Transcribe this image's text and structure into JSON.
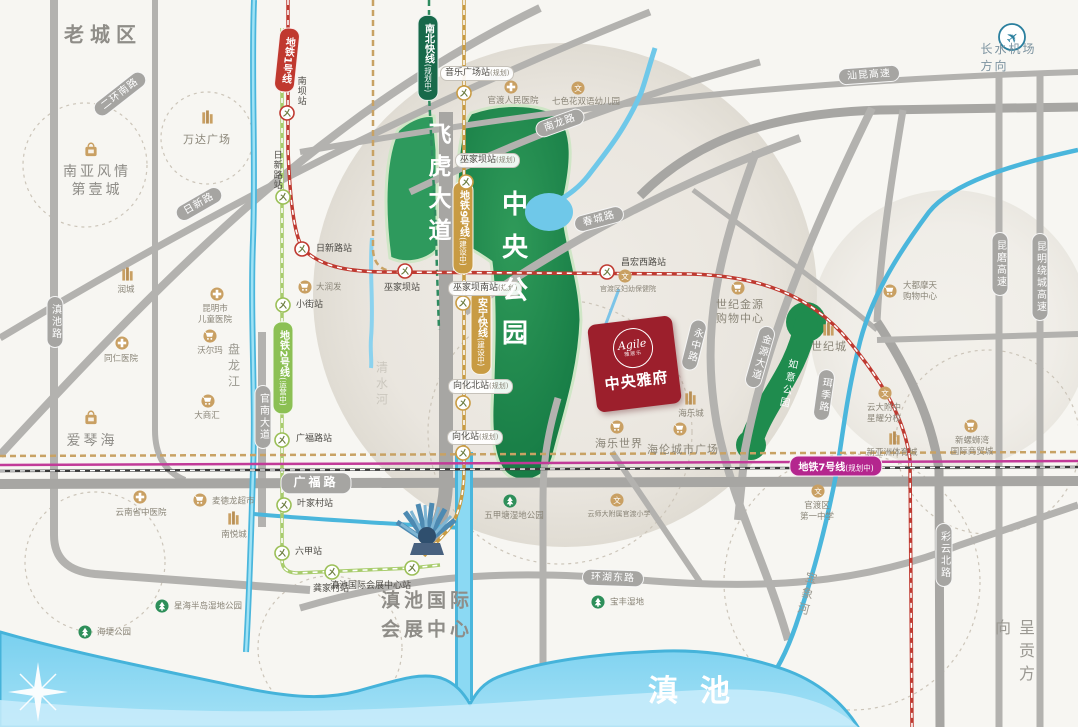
{
  "project": {
    "name": "中央雅府",
    "brand": "Agile",
    "brand_sub": "雅居乐"
  },
  "colors": {
    "project_red": "#9c1f2c",
    "metro1_red": "#c0392f",
    "metro2_green": "#8cc054",
    "metro9_gold": "#c89b43",
    "metro7_magenta": "#b4268e",
    "nbkx_green": "#17694a",
    "water": "#45b3da",
    "park_green": "#1f8c4e",
    "road_gray": "#b0afac",
    "poi_gold": "#c9a063"
  },
  "areas": [
    {
      "t": "老城区",
      "x": 103,
      "y": 33,
      "cls": "a-big"
    },
    {
      "t": "中央公园",
      "x": 513,
      "y": 276,
      "cls": "a-parkbig"
    },
    {
      "t": "飞虎大道",
      "x": 437,
      "y": 186,
      "cls": "a-roadbig"
    },
    {
      "t": "清水河",
      "x": 382,
      "y": 385,
      "cls": "a-riverlt"
    },
    {
      "t": "盘龙江",
      "x": 234,
      "y": 367,
      "cls": "a-river"
    },
    {
      "t": "宝象河",
      "x": 807,
      "y": 595,
      "cls": "a-river",
      "rot": 14
    },
    {
      "t": "如意公园",
      "x": 787,
      "y": 384,
      "cls": "a-parksm",
      "rot": 12
    },
    {
      "t": "呈贡方向",
      "x": 1013,
      "y": 655,
      "cls": "a-dir"
    },
    {
      "t": "长水机场方向",
      "x": 1013,
      "y": 57,
      "cls": "a-air"
    },
    {
      "t": "滇池",
      "x": 700,
      "y": 688,
      "cls": "a-lake"
    },
    {
      "t": "滇池国际\n会展中心",
      "x": 427,
      "y": 615,
      "cls": "a-big2"
    }
  ],
  "road_pills": [
    {
      "t": "二环南路",
      "x": 120,
      "y": 94,
      "rot": -38
    },
    {
      "t": "日新路",
      "x": 199,
      "y": 204,
      "rot": -30
    },
    {
      "t": "滇池路",
      "x": 55,
      "y": 322,
      "v": 1
    },
    {
      "t": "官南大道",
      "x": 263,
      "y": 417,
      "v": 1
    },
    {
      "t": "南龙路",
      "x": 560,
      "y": 123,
      "rot": -20
    },
    {
      "t": "春城路",
      "x": 599,
      "y": 219,
      "rot": -15
    },
    {
      "t": "汕昆高速",
      "x": 869,
      "y": 75,
      "rot": -4
    },
    {
      "t": "昆磨高速",
      "x": 1000,
      "y": 264,
      "v": 1
    },
    {
      "t": "昆明绕城高速",
      "x": 1040,
      "y": 277,
      "v": 1
    },
    {
      "t": "广福路",
      "x": 316,
      "y": 483,
      "big": 1
    },
    {
      "t": "环湖东路",
      "x": 613,
      "y": 578,
      "rot": 2
    },
    {
      "t": "彩云北路",
      "x": 944,
      "y": 555,
      "v": 1
    },
    {
      "t": "金源大道",
      "x": 760,
      "y": 357,
      "v": 1,
      "rot": 16
    },
    {
      "t": "永中路",
      "x": 694,
      "y": 345,
      "v": 1,
      "rot": 14
    },
    {
      "t": "珥季路",
      "x": 824,
      "y": 395,
      "v": 1,
      "rot": 8
    }
  ],
  "metro_pills": [
    {
      "t": "地铁1号线",
      "x": 287,
      "y": 60,
      "v": 1,
      "rot": 6,
      "c": "#c0392f"
    },
    {
      "t": "地铁2号线",
      "s": "(运营中)",
      "x": 283,
      "y": 368,
      "v": 1,
      "c": "#8cc054"
    },
    {
      "t": "南北快线",
      "s": "(规划中)",
      "x": 428,
      "y": 58,
      "v": 1,
      "c": "#17694a"
    },
    {
      "t": "地铁9号线",
      "s": "(建设中)",
      "x": 463,
      "y": 228,
      "v": 1,
      "c": "#c89b43"
    },
    {
      "t": "安宁快线",
      "s": "(建设中)",
      "x": 481,
      "y": 332,
      "v": 1,
      "c": "#c89b43"
    },
    {
      "t": "地铁7号线",
      "s": "(规划中)",
      "x": 836,
      "y": 466,
      "c": "#b4268e"
    }
  ],
  "stations": [
    {
      "t": "南坝站",
      "x": 287,
      "y": 113,
      "l": "red",
      "lx": 294,
      "ly": 76,
      "cls": "v plain"
    },
    {
      "t": "日新路站",
      "x": 283,
      "y": 197,
      "l": "green",
      "lx": 270,
      "ly": 150,
      "cls": "v plain"
    },
    {
      "t": "日新路站",
      "x": 302,
      "y": 249,
      "l": "red",
      "lx": 316,
      "ly": 243,
      "cls": "plain"
    },
    {
      "t": "小街站",
      "x": 283,
      "y": 305,
      "l": "green",
      "lx": 296,
      "ly": 299,
      "cls": "plain"
    },
    {
      "t": "广福路站",
      "x": 282,
      "y": 440,
      "l": "green",
      "lx": 296,
      "ly": 433,
      "cls": "plain"
    },
    {
      "t": "叶家村站",
      "x": 284,
      "y": 505,
      "l": "green",
      "lx": 297,
      "ly": 498,
      "cls": "plain"
    },
    {
      "t": "六甲站",
      "x": 282,
      "y": 553,
      "l": "green",
      "lx": 295,
      "ly": 546,
      "cls": "plain"
    },
    {
      "t": "龚家村站",
      "x": 332,
      "y": 572,
      "l": "green",
      "lx": 313,
      "ly": 583,
      "cls": "plain"
    },
    {
      "t": "滇池国际会展中心站",
      "x": 412,
      "y": 568,
      "l": "green",
      "lx": 330,
      "ly": 580,
      "cls": "plain"
    },
    {
      "t": "音乐广场站",
      "s": "(规划)",
      "x": 464,
      "y": 93,
      "l": "gold",
      "lx": 440,
      "ly": 66
    },
    {
      "t": "巫家坝站",
      "s": "(规划)",
      "x": 466,
      "y": 182,
      "l": "gold",
      "lx": 455,
      "ly": 153
    },
    {
      "t": "巫家坝南站",
      "s": "(规划)",
      "x": 463,
      "y": 303,
      "l": "gold",
      "lx": 448,
      "ly": 281
    },
    {
      "t": "向化北站",
      "s": "(规划)",
      "x": 463,
      "y": 403,
      "l": "gold",
      "lx": 448,
      "ly": 379
    },
    {
      "t": "向化站",
      "s": "(规划)",
      "x": 463,
      "y": 453,
      "l": "gold",
      "lx": 447,
      "ly": 430
    },
    {
      "t": "巫家坝站",
      "x": 405,
      "y": 271,
      "l": "red",
      "lx": 384,
      "ly": 282,
      "cls": "plain"
    },
    {
      "t": "昌宏西路站",
      "x": 607,
      "y": 272,
      "l": "red",
      "lx": 621,
      "ly": 257,
      "cls": "plain"
    }
  ],
  "pois": [
    {
      "icon": "building",
      "ix": 207,
      "iy": 117,
      "t": "万达广场",
      "lx": 207,
      "ly": 133,
      "cls": "md"
    },
    {
      "icon": "bag",
      "ix": 91,
      "iy": 150,
      "t": "南亚风情\n第壹城",
      "lx": 97,
      "ly": 163,
      "cls": "lg"
    },
    {
      "icon": "cross",
      "ix": 511,
      "iy": 87,
      "t": "官渡人民医院",
      "lx": 513,
      "ly": 96
    },
    {
      "icon": "school",
      "ix": 578,
      "iy": 88,
      "t": "七色花双语幼儿园",
      "lx": 586,
      "ly": 97
    },
    {
      "icon": "building",
      "ix": 127,
      "iy": 274,
      "t": "润城",
      "lx": 126,
      "ly": 285
    },
    {
      "icon": "cross",
      "ix": 217,
      "iy": 294,
      "t": "昆明市\n儿童医院",
      "lx": 215,
      "ly": 304
    },
    {
      "icon": "cart",
      "ix": 210,
      "iy": 336,
      "t": "沃尔玛",
      "lx": 210,
      "ly": 346
    },
    {
      "icon": "cross",
      "ix": 122,
      "iy": 343,
      "t": "同仁医院",
      "lx": 121,
      "ly": 354
    },
    {
      "icon": "cart",
      "ix": 208,
      "iy": 401,
      "t": "大商汇",
      "lx": 207,
      "ly": 411
    },
    {
      "icon": "bag",
      "ix": 91,
      "iy": 418,
      "t": "爱琴海",
      "lx": 92,
      "ly": 432,
      "cls": "lg"
    },
    {
      "icon": "cart",
      "ix": 305,
      "iy": 287,
      "t": "大润发",
      "lx": 316,
      "ly": 288,
      "cls": "r"
    },
    {
      "icon": "cross",
      "ix": 140,
      "iy": 497,
      "t": "云南省中医院",
      "lx": 141,
      "ly": 508
    },
    {
      "icon": "cart",
      "ix": 200,
      "iy": 500,
      "t": "麦德龙超市",
      "lx": 212,
      "ly": 502,
      "cls": "r"
    },
    {
      "icon": "building",
      "ix": 233,
      "iy": 518,
      "t": "南悦城",
      "lx": 234,
      "ly": 530
    },
    {
      "icon": "tree",
      "ix": 162,
      "iy": 606,
      "t": "星海半岛湿地公园",
      "lx": 174,
      "ly": 607,
      "cls": "r"
    },
    {
      "icon": "tree",
      "ix": 85,
      "iy": 632,
      "t": "海埂公园",
      "lx": 97,
      "ly": 633,
      "cls": "r"
    },
    {
      "icon": "tree",
      "ix": 510,
      "iy": 501,
      "t": "五甲塘湿地公园",
      "lx": 514,
      "ly": 511
    },
    {
      "icon": "tree",
      "ix": 598,
      "iy": 602,
      "t": "宝丰湿地",
      "lx": 610,
      "ly": 603,
      "cls": "r"
    },
    {
      "icon": "school",
      "ix": 617,
      "iy": 500,
      "t": "云师大附属官渡小学",
      "lx": 619,
      "ly": 510,
      "cls": "tiny"
    },
    {
      "icon": "cart",
      "ix": 617,
      "iy": 427,
      "t": "海乐世界",
      "lx": 619,
      "ly": 437,
      "cls": "md"
    },
    {
      "icon": "cart",
      "ix": 680,
      "iy": 429,
      "t": "海伦城市广场",
      "lx": 683,
      "ly": 443,
      "cls": "md"
    },
    {
      "icon": "building",
      "ix": 690,
      "iy": 398,
      "t": "海乐城",
      "lx": 691,
      "ly": 409
    },
    {
      "icon": "cart",
      "ix": 738,
      "iy": 288,
      "t": "世纪金源\n购物中心",
      "lx": 740,
      "ly": 298,
      "cls": "md"
    },
    {
      "icon": "building",
      "ix": 828,
      "iy": 329,
      "t": "世纪城",
      "lx": 829,
      "ly": 340,
      "cls": "md"
    },
    {
      "icon": "school",
      "ix": 885,
      "iy": 393,
      "t": "云大附中\n星耀分校",
      "lx": 884,
      "ly": 403
    },
    {
      "icon": "building",
      "ix": 894,
      "iy": 438,
      "t": "新亚洲体育城",
      "lx": 892,
      "ly": 448
    },
    {
      "icon": "cart",
      "ix": 890,
      "iy": 291,
      "t": "大都摩天\n购物中心",
      "lx": 903,
      "ly": 292,
      "cls": "r"
    },
    {
      "icon": "cart",
      "ix": 971,
      "iy": 426,
      "t": "新螺蛳湾\n国际商贸城",
      "lx": 972,
      "ly": 436
    },
    {
      "icon": "school",
      "ix": 818,
      "iy": 491,
      "t": "官渡区\n第一中学",
      "lx": 817,
      "ly": 501
    },
    {
      "icon": "school",
      "ix": 625,
      "iy": 276,
      "t": "官渡区妇幼保健院",
      "lx": 628,
      "ly": 285,
      "cls": "tiny"
    }
  ]
}
